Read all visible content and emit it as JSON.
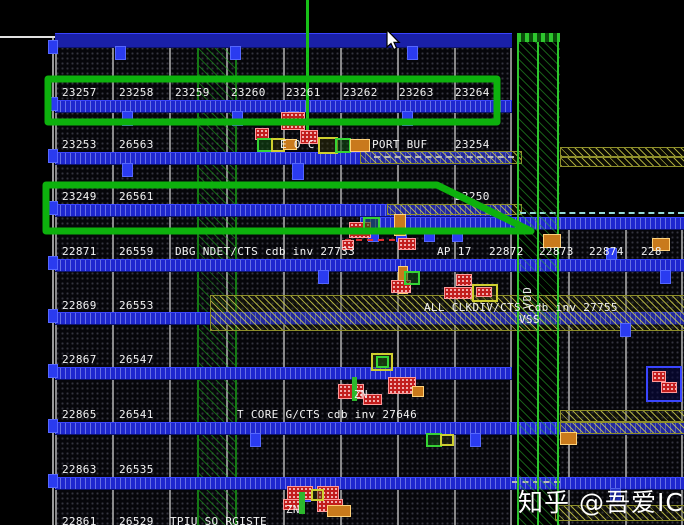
{
  "rows": [
    {
      "labels": [
        {
          "t": "23257"
        },
        {
          "t": "23258"
        },
        {
          "t": "23259"
        },
        {
          "t": "23260"
        },
        {
          "t": "23261"
        },
        {
          "t": "23262"
        },
        {
          "t": "23263"
        },
        {
          "t": "23264"
        }
      ]
    },
    {
      "labels": [
        {
          "t": "23253"
        },
        {
          "t": "26563"
        },
        {
          "t": "E O C"
        },
        {
          "t": "PORT BUF"
        },
        {
          "t": "23254"
        }
      ]
    },
    {
      "labels": [
        {
          "t": "23249"
        },
        {
          "t": "26561"
        },
        {
          "t": "23250"
        }
      ]
    },
    {
      "labels": [
        {
          "t": "22871"
        },
        {
          "t": "26559"
        },
        {
          "t": "DBG NDET/CTS cdb inv 27733"
        },
        {
          "t": "AP 17"
        },
        {
          "t": "22872"
        },
        {
          "t": "22873"
        },
        {
          "t": "22874"
        },
        {
          "t": "228"
        }
      ]
    },
    {
      "labels": [
        {
          "t": "22869"
        },
        {
          "t": "26553"
        },
        {
          "t": "ALL CLKDIV/CTS cdb inv 27755"
        },
        {
          "t": "VSS"
        }
      ]
    },
    {
      "labels": [
        {
          "t": "22867"
        },
        {
          "t": "26547"
        }
      ]
    },
    {
      "labels": [
        {
          "t": "22865"
        },
        {
          "t": "26541"
        },
        {
          "t": "T CORE G/CTS cdb inv 27646"
        },
        {
          "t": "ZN"
        }
      ]
    },
    {
      "labels": [
        {
          "t": "22863"
        },
        {
          "t": "26535"
        }
      ]
    },
    {
      "labels": [
        {
          "t": "22861"
        },
        {
          "t": "26529"
        },
        {
          "t": "TPIU SO RGISTE"
        },
        {
          "t": "ZN"
        }
      ]
    }
  ],
  "power": {
    "vdd": "VDD"
  },
  "watermark": {
    "text": "知乎 @吾爱IC"
  },
  "colors": {
    "background": "#000000",
    "annotation_green": "#0db10d",
    "rail_blue": "#1e27cf",
    "strap_green": "#2ec62e",
    "route_olive": "#9b9b2c",
    "cell_red": "#c21d1d",
    "label_white": "#f2f2f2"
  }
}
